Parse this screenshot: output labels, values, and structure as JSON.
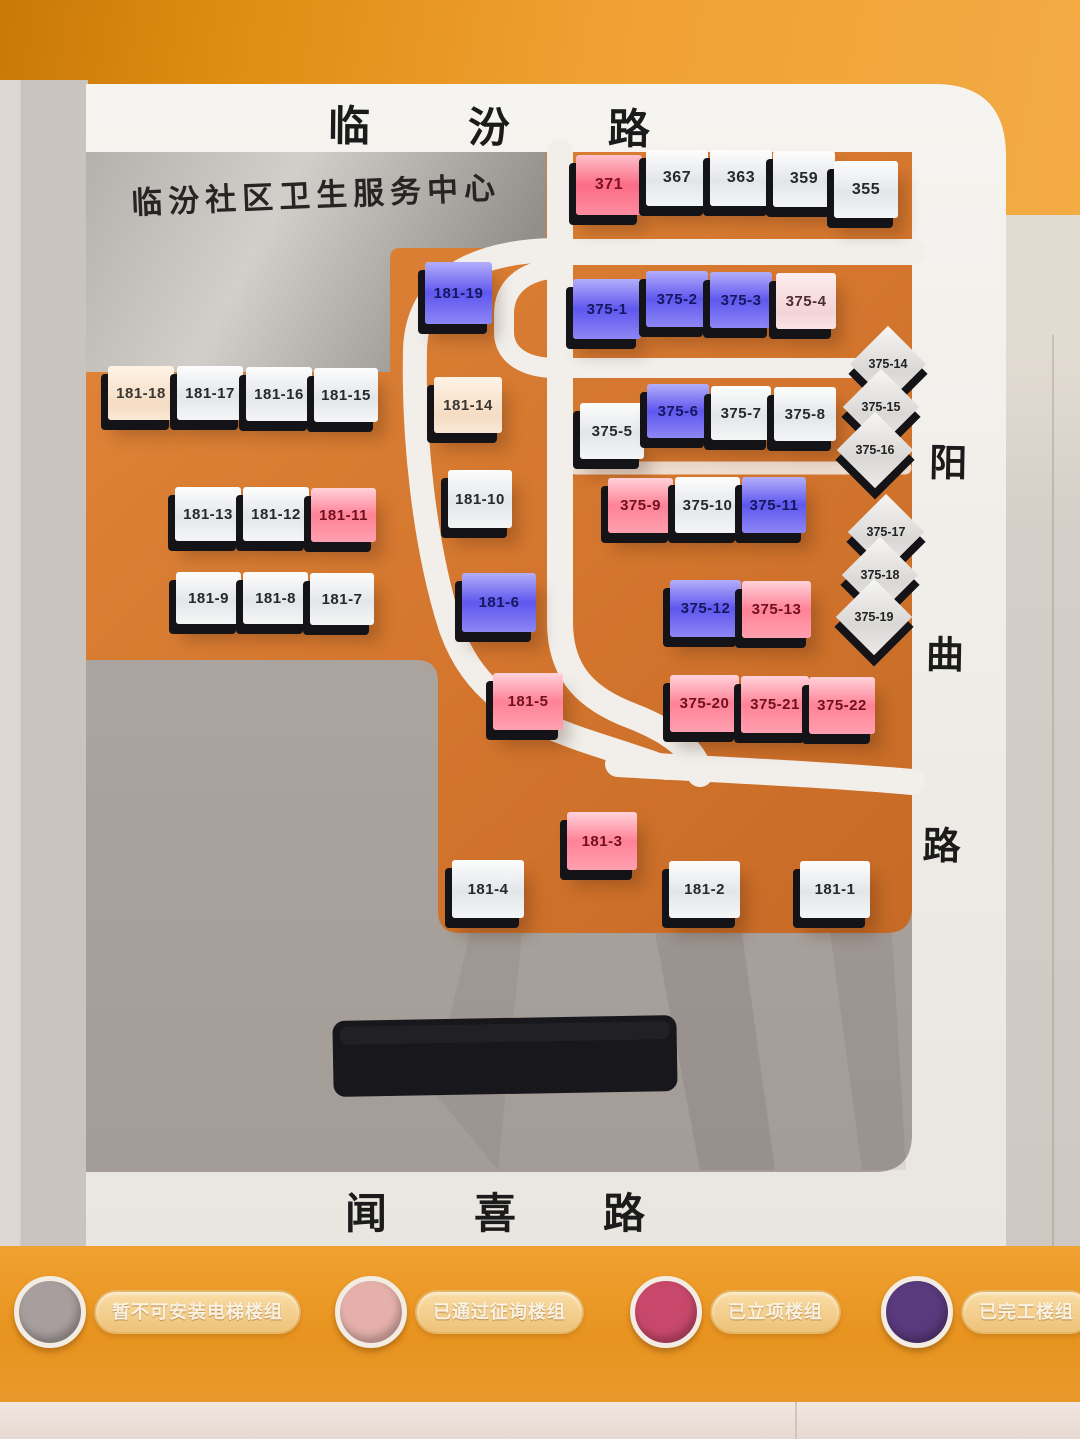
{
  "board": {
    "title_panel": "临汾社区卫生服务中心",
    "roads": {
      "top": {
        "name": "临汾路",
        "chars": [
          "临",
          "汾",
          "路"
        ]
      },
      "right": {
        "name": "阳曲路",
        "chars": [
          "阳",
          "曲",
          "路"
        ]
      },
      "bottom": {
        "name": "闻喜路",
        "chars": [
          "闻",
          "喜",
          "路"
        ]
      }
    },
    "tiles": [
      {
        "label": "371",
        "color": "red",
        "x": 576,
        "y": 155,
        "w": 66,
        "h": 60
      },
      {
        "label": "367",
        "color": "white",
        "x": 646,
        "y": 150,
        "w": 62,
        "h": 56
      },
      {
        "label": "363",
        "color": "white",
        "x": 710,
        "y": 150,
        "w": 62,
        "h": 56
      },
      {
        "label": "359",
        "color": "white",
        "x": 773,
        "y": 151,
        "w": 62,
        "h": 56
      },
      {
        "label": "355",
        "color": "white",
        "x": 834,
        "y": 161,
        "w": 64,
        "h": 57
      },
      {
        "label": "181-19",
        "color": "blue",
        "x": 425,
        "y": 262,
        "w": 67,
        "h": 62
      },
      {
        "label": "375-1",
        "color": "blue",
        "x": 573,
        "y": 279,
        "w": 68,
        "h": 60
      },
      {
        "label": "375-2",
        "color": "blue",
        "x": 646,
        "y": 271,
        "w": 62,
        "h": 56
      },
      {
        "label": "375-3",
        "color": "blue",
        "x": 710,
        "y": 272,
        "w": 62,
        "h": 56
      },
      {
        "label": "375-4",
        "color": "pinkwhite",
        "x": 776,
        "y": 273,
        "w": 60,
        "h": 56
      },
      {
        "label": "181-18",
        "color": "cream",
        "x": 108,
        "y": 366,
        "w": 66,
        "h": 54
      },
      {
        "label": "181-17",
        "color": "white",
        "x": 177,
        "y": 366,
        "w": 66,
        "h": 54
      },
      {
        "label": "181-16",
        "color": "white",
        "x": 246,
        "y": 367,
        "w": 66,
        "h": 54
      },
      {
        "label": "181-15",
        "color": "white",
        "x": 314,
        "y": 368,
        "w": 64,
        "h": 54
      },
      {
        "label": "181-14",
        "color": "cream",
        "x": 434,
        "y": 377,
        "w": 68,
        "h": 56
      },
      {
        "label": "375-5",
        "color": "white",
        "x": 580,
        "y": 403,
        "w": 64,
        "h": 56
      },
      {
        "label": "375-6",
        "color": "blue",
        "x": 647,
        "y": 384,
        "w": 62,
        "h": 54
      },
      {
        "label": "375-7",
        "color": "white",
        "x": 711,
        "y": 386,
        "w": 60,
        "h": 54
      },
      {
        "label": "375-8",
        "color": "white",
        "x": 774,
        "y": 387,
        "w": 62,
        "h": 54
      },
      {
        "label": "181-13",
        "color": "white",
        "x": 175,
        "y": 487,
        "w": 66,
        "h": 54
      },
      {
        "label": "181-12",
        "color": "white",
        "x": 243,
        "y": 487,
        "w": 66,
        "h": 54
      },
      {
        "label": "181-11",
        "color": "pink",
        "x": 311,
        "y": 488,
        "w": 65,
        "h": 54
      },
      {
        "label": "181-10",
        "color": "white",
        "x": 448,
        "y": 470,
        "w": 64,
        "h": 58
      },
      {
        "label": "375-9",
        "color": "pink",
        "x": 608,
        "y": 478,
        "w": 65,
        "h": 55
      },
      {
        "label": "375-10",
        "color": "white",
        "x": 675,
        "y": 477,
        "w": 65,
        "h": 56
      },
      {
        "label": "375-11",
        "color": "blue",
        "x": 742,
        "y": 477,
        "w": 64,
        "h": 56
      },
      {
        "label": "181-9",
        "color": "white",
        "x": 176,
        "y": 572,
        "w": 65,
        "h": 52
      },
      {
        "label": "181-8",
        "color": "white",
        "x": 243,
        "y": 572,
        "w": 65,
        "h": 52
      },
      {
        "label": "181-7",
        "color": "white",
        "x": 310,
        "y": 573,
        "w": 64,
        "h": 52
      },
      {
        "label": "181-6",
        "color": "blue",
        "x": 462,
        "y": 573,
        "w": 74,
        "h": 59
      },
      {
        "label": "375-12",
        "color": "blue",
        "x": 670,
        "y": 580,
        "w": 71,
        "h": 57
      },
      {
        "label": "375-13",
        "color": "pink",
        "x": 742,
        "y": 581,
        "w": 69,
        "h": 57
      },
      {
        "label": "181-5",
        "color": "pink",
        "x": 493,
        "y": 673,
        "w": 70,
        "h": 57
      },
      {
        "label": "375-20",
        "color": "pink",
        "x": 670,
        "y": 675,
        "w": 69,
        "h": 57
      },
      {
        "label": "375-21",
        "color": "pink",
        "x": 741,
        "y": 676,
        "w": 68,
        "h": 57
      },
      {
        "label": "375-22",
        "color": "pink",
        "x": 809,
        "y": 677,
        "w": 66,
        "h": 57
      },
      {
        "label": "181-3",
        "color": "pink",
        "x": 567,
        "y": 812,
        "w": 70,
        "h": 58
      },
      {
        "label": "181-4",
        "color": "white",
        "x": 452,
        "y": 860,
        "w": 72,
        "h": 58
      },
      {
        "label": "181-2",
        "color": "white",
        "x": 669,
        "y": 861,
        "w": 71,
        "h": 57
      },
      {
        "label": "181-1",
        "color": "white",
        "x": 800,
        "y": 861,
        "w": 70,
        "h": 57
      }
    ],
    "diamonds": [
      {
        "label": "375-14",
        "cx": 888,
        "cy": 364
      },
      {
        "label": "375-15",
        "cx": 881,
        "cy": 407
      },
      {
        "label": "375-16",
        "cx": 875,
        "cy": 450
      },
      {
        "label": "375-17",
        "cx": 886,
        "cy": 532
      },
      {
        "label": "375-18",
        "cx": 880,
        "cy": 575
      },
      {
        "label": "375-19",
        "cx": 874,
        "cy": 617
      }
    ],
    "legend": [
      {
        "label": "暂不可安装电梯楼组",
        "color": "#a89e9d"
      },
      {
        "label": "已通过征询楼组",
        "color": "#e5b0aa"
      },
      {
        "label": "已立项楼组",
        "color": "#c8486b"
      },
      {
        "label": "已完工楼组",
        "color": "#593a7d"
      }
    ],
    "colors": {
      "map_orange": "#d4762e",
      "road_white": "#f2efeb",
      "wall_orange": "#eb9a28",
      "tile_red": "#fb6d86",
      "tile_pink": "#ff8296",
      "tile_blue": "#5f57ee",
      "tile_white": "#eef0f1",
      "tile_cream": "#f5dcc3",
      "tile_pinkwhite": "#f4d4d7",
      "sign_black": "#18181c"
    }
  }
}
